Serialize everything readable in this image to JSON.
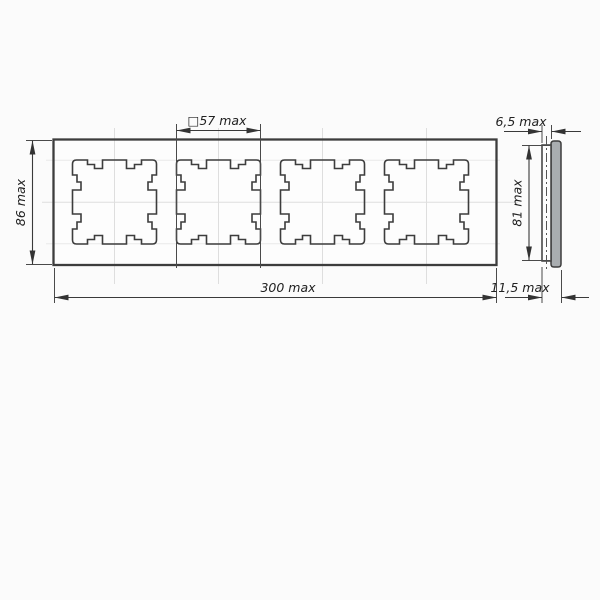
{
  "drawing": {
    "dimensions": {
      "opening_square": "□57 max",
      "overall_height": "86 max",
      "overall_width": "300 max",
      "front_depth": "6,5 max",
      "side_inner_height": "81 max",
      "total_depth": "11,5 max"
    },
    "values_mm": {
      "opening_square": 57,
      "overall_height": 86,
      "overall_width": 300,
      "front_depth": 6.5,
      "side_inner_height": 81,
      "total_depth": 11.5
    },
    "front_view": {
      "openings_count": 4
    },
    "colors": {
      "background": "#fbfbfb",
      "outline": "#3d3d3d",
      "dimension_line": "#3a3a3a",
      "centerline": "#dedede",
      "side_plate_fill": "#a9adb0"
    }
  }
}
